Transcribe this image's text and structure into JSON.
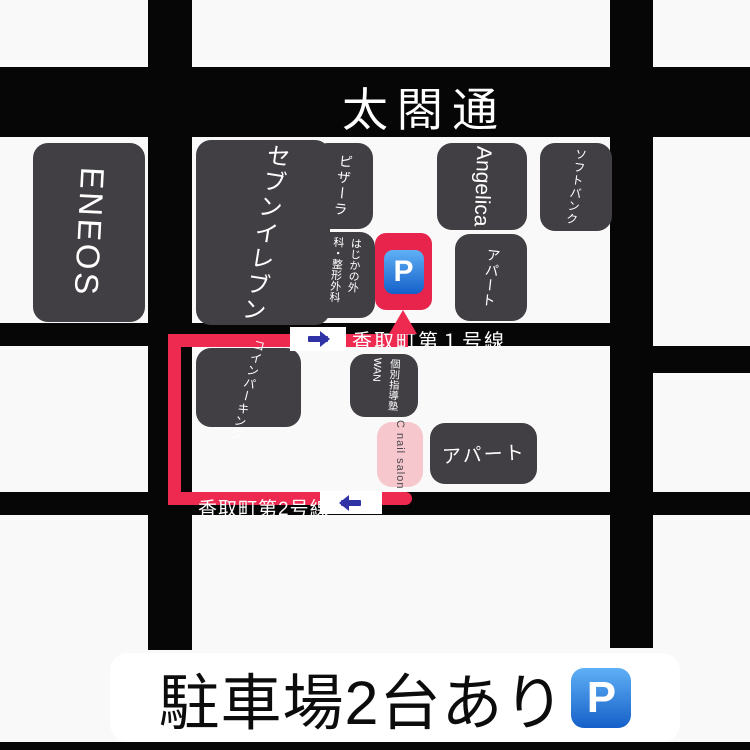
{
  "title_road": {
    "label": "太閤通"
  },
  "streets": {
    "street1": {
      "label": "香取町第１号線"
    },
    "street2": {
      "label": "香取町第2号線"
    }
  },
  "buildings": {
    "eneos": {
      "label": "ENEOS"
    },
    "seven_eleven": {
      "label": "セブンイレブン"
    },
    "pizza_la": {
      "label": "ピザーラ"
    },
    "hajika_clinic": {
      "label": "はじかの外科・整形外科"
    },
    "angelica": {
      "label": "Angelica"
    },
    "softbank": {
      "label": "ソフトバンク"
    },
    "apartment_upper": {
      "label": "アパート"
    },
    "coin_parking": {
      "label": "コインパーキング"
    },
    "juku_wan": {
      "label": "個別指導塾WAN"
    },
    "c_nail_salon": {
      "label": "C nail salon"
    },
    "apartment_lower": {
      "label": "アパート"
    }
  },
  "parking_marker": {
    "letter": "P"
  },
  "banner": {
    "text": "駐車場2台あり",
    "parking_letter": "P"
  },
  "colors": {
    "road": "#060606",
    "building": "#413f44",
    "route": "#ee2a50",
    "nail": "#f6c7cc",
    "pred": "#e8244c",
    "pblue1": "#5fb0f6",
    "pblue2": "#1560c9",
    "sign_blue": "#2f33a6"
  }
}
